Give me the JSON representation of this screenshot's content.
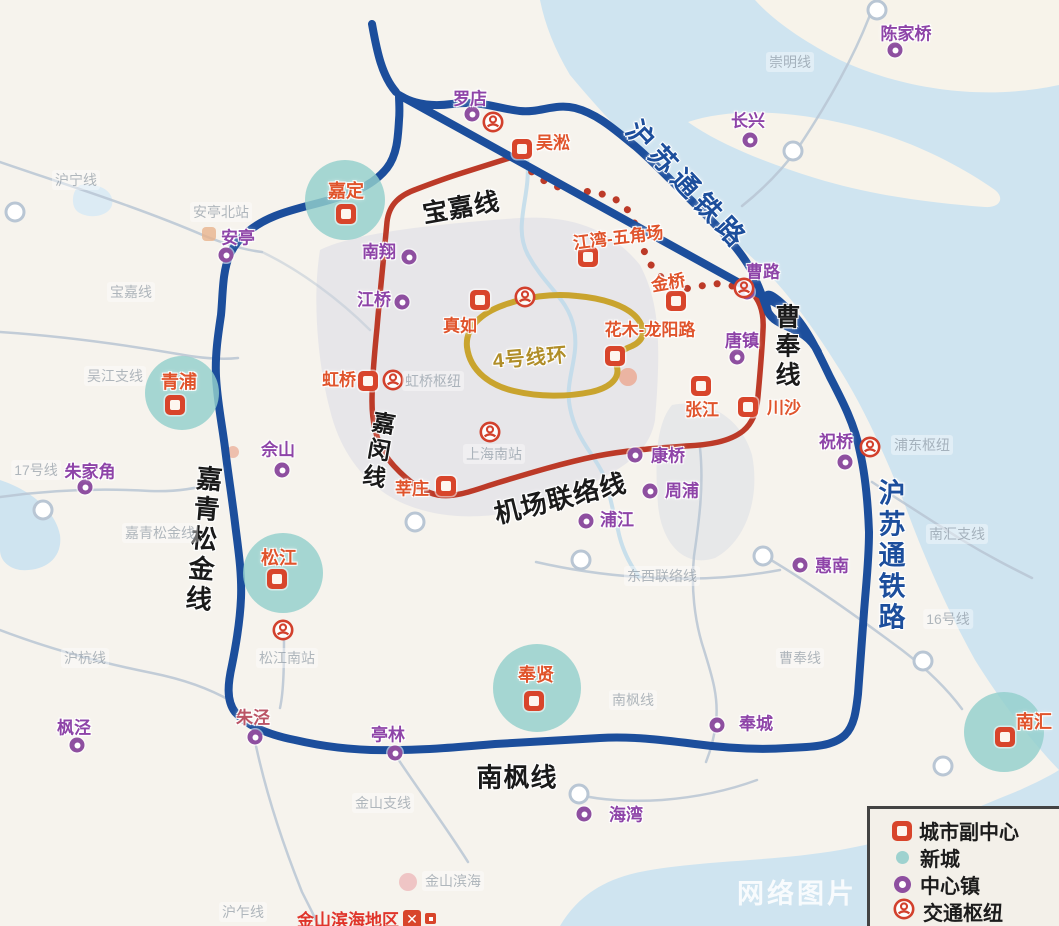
{
  "map": {
    "watermark": "网络图片",
    "colors": {
      "blue_line": "#1c4e9c",
      "red_line": "#bc3a28",
      "gold_line": "#c9a42e",
      "town_purple": "#8e44a8",
      "subcenter_red": "#d8452b",
      "newcity_teal": "#9ed2cf",
      "water": "#cfe4f0"
    },
    "legend": {
      "items": [
        {
          "type": "sub-center",
          "label": "城市副中心"
        },
        {
          "type": "new-city",
          "label": "新城"
        },
        {
          "type": "town",
          "label": "中心镇"
        },
        {
          "type": "hub",
          "label": "交通枢纽"
        }
      ]
    },
    "line_labels": [
      {
        "text": "宝嘉线",
        "x": 461,
        "y": 206,
        "rotate": -10,
        "size": 25,
        "color": "#1a1a1a",
        "vertical": false
      },
      {
        "text": "沪苏通铁路",
        "x": 689,
        "y": 184,
        "rotate": 47,
        "size": 27,
        "color": "#1c4e9c",
        "vertical": false,
        "spacing": 6
      },
      {
        "text": "曹奉线",
        "x": 786,
        "y": 347,
        "rotate": 0,
        "size": 25,
        "color": "#1a1a1a",
        "vertical": true
      },
      {
        "text": "嘉闵线",
        "x": 377,
        "y": 451,
        "rotate": 10,
        "size": 23,
        "color": "#1a1a1a",
        "vertical": true
      },
      {
        "text": "机场联络线",
        "x": 560,
        "y": 497,
        "rotate": -14,
        "size": 26,
        "color": "#1a1a1a",
        "vertical": false
      },
      {
        "text": "嘉青松金线",
        "x": 203,
        "y": 540,
        "rotate": 5,
        "size": 26,
        "color": "#1a1a1a",
        "vertical": true
      },
      {
        "text": "南枫线",
        "x": 517,
        "y": 776,
        "rotate": 0,
        "size": 26,
        "color": "#1a1a1a",
        "vertical": false
      },
      {
        "text": "沪苏通铁路",
        "x": 890,
        "y": 556,
        "rotate": 0,
        "size": 27,
        "color": "#1c4e9c",
        "vertical": true
      },
      {
        "text": "4号线环",
        "x": 530,
        "y": 356,
        "rotate": -5,
        "size": 20,
        "color": "#b08e28",
        "vertical": false
      }
    ],
    "sub_centers": [
      {
        "name": "吴淞",
        "x": 522,
        "y": 149,
        "lx": 553,
        "ly": 141
      },
      {
        "name": "江湾-五角场",
        "x": 588,
        "y": 257,
        "lx": 618,
        "ly": 236,
        "lrot": -7
      },
      {
        "name": "金桥",
        "x": 676,
        "y": 301,
        "lx": 668,
        "ly": 281,
        "lrot": -10
      },
      {
        "name": "真如",
        "x": 480,
        "y": 300,
        "lx": 460,
        "ly": 324
      },
      {
        "name": "花木-龙阳路",
        "x": 615,
        "y": 356,
        "lx": 650,
        "ly": 328
      },
      {
        "name": "虹桥",
        "x": 368,
        "y": 381,
        "lx": 339,
        "ly": 378
      },
      {
        "name": "张江",
        "x": 701,
        "y": 386,
        "lx": 702,
        "ly": 408
      },
      {
        "name": "川沙",
        "x": 748,
        "y": 407,
        "lx": 784,
        "ly": 406
      },
      {
        "name": "莘庄",
        "x": 446,
        "y": 486,
        "lx": 412,
        "ly": 487
      }
    ],
    "new_cities": [
      {
        "name": "嘉定",
        "cx": 345,
        "cy": 200,
        "r": 40,
        "lx": 346,
        "ly": 190,
        "sx": 346,
        "sy": 214
      },
      {
        "name": "青浦",
        "cx": 182,
        "cy": 393,
        "r": 37,
        "lx": 179,
        "ly": 381,
        "sx": 175,
        "sy": 405
      },
      {
        "name": "松江",
        "cx": 283,
        "cy": 573,
        "r": 40,
        "lx": 279,
        "ly": 557,
        "sx": 277,
        "sy": 579
      },
      {
        "name": "奉贤",
        "cx": 537,
        "cy": 688,
        "r": 44,
        "lx": 536,
        "ly": 674,
        "sx": 534,
        "sy": 701
      },
      {
        "name": "南汇",
        "cx": 1004,
        "cy": 732,
        "r": 40,
        "lx": 1034,
        "ly": 721,
        "sx": 1005,
        "sy": 737
      }
    ],
    "towns": [
      {
        "name": "罗店",
        "cx": 472,
        "cy": 114,
        "lx": 470,
        "ly": 97
      },
      {
        "name": "安亭",
        "cx": 226,
        "cy": 255,
        "lx": 238,
        "ly": 236
      },
      {
        "name": "南翔",
        "cx": 409,
        "cy": 257,
        "lx": 379,
        "ly": 250
      },
      {
        "name": "江桥",
        "cx": 402,
        "cy": 302,
        "lx": 374,
        "ly": 298
      },
      {
        "name": "佘山",
        "cx": 282,
        "cy": 470,
        "lx": 278,
        "ly": 448
      },
      {
        "name": "朱家角",
        "cx": 85,
        "cy": 487,
        "lx": 90,
        "ly": 470
      },
      {
        "name": "长兴",
        "cx": 750,
        "cy": 140,
        "lx": 748,
        "ly": 119
      },
      {
        "name": "陈家桥",
        "cx": 895,
        "cy": 50,
        "lx": 906,
        "ly": 32
      },
      {
        "name": "曹路",
        "cx": 747,
        "cy": 292,
        "lx": 763,
        "ly": 270
      },
      {
        "name": "唐镇",
        "cx": 737,
        "cy": 357,
        "lx": 742,
        "ly": 339
      },
      {
        "name": "康桥",
        "cx": 635,
        "cy": 455,
        "lx": 668,
        "ly": 454
      },
      {
        "name": "周浦",
        "cx": 650,
        "cy": 491,
        "lx": 682,
        "ly": 489
      },
      {
        "name": "浦江",
        "cx": 586,
        "cy": 521,
        "lx": 617,
        "ly": 518
      },
      {
        "name": "祝桥",
        "cx": 845,
        "cy": 462,
        "lx": 836,
        "ly": 440
      },
      {
        "name": "惠南",
        "cx": 800,
        "cy": 565,
        "lx": 832,
        "ly": 564
      },
      {
        "name": "奉城",
        "cx": 717,
        "cy": 725,
        "lx": 756,
        "ly": 722
      },
      {
        "name": "海湾",
        "cx": 584,
        "cy": 814,
        "lx": 626,
        "ly": 813
      },
      {
        "name": "亭林",
        "cx": 395,
        "cy": 753,
        "lx": 388,
        "ly": 733
      },
      {
        "name": "枫泾",
        "cx": 77,
        "cy": 745,
        "lx": 74,
        "ly": 726
      },
      {
        "name": "朱泾",
        "cx": 255,
        "cy": 737,
        "lx": 253,
        "ly": 716,
        "color": "#bb5566"
      }
    ],
    "hubs": [
      {
        "x": 493,
        "y": 122
      },
      {
        "x": 525,
        "y": 297
      },
      {
        "x": 393,
        "y": 380
      },
      {
        "x": 490,
        "y": 432
      },
      {
        "x": 283,
        "y": 630
      },
      {
        "x": 870,
        "y": 447
      },
      {
        "x": 744,
        "y": 288
      }
    ],
    "faint_labels": [
      {
        "text": "沪宁线",
        "x": 76,
        "y": 180
      },
      {
        "text": "安亭北站",
        "x": 221,
        "y": 212
      },
      {
        "text": "宝嘉线",
        "x": 131,
        "y": 292
      },
      {
        "text": "吴江支线",
        "x": 115,
        "y": 376
      },
      {
        "text": "17号线",
        "x": 36,
        "y": 470
      },
      {
        "text": "嘉青松金线",
        "x": 160,
        "y": 533
      },
      {
        "text": "虹桥枢纽",
        "x": 433,
        "y": 381
      },
      {
        "text": "上海南站",
        "x": 494,
        "y": 454
      },
      {
        "text": "浦东枢纽",
        "x": 922,
        "y": 445
      },
      {
        "text": "南汇支线",
        "x": 957,
        "y": 534
      },
      {
        "text": "16号线",
        "x": 948,
        "y": 619
      },
      {
        "text": "曹奉线",
        "x": 800,
        "y": 658
      },
      {
        "text": "南枫线",
        "x": 633,
        "y": 700
      },
      {
        "text": "东西联络线",
        "x": 662,
        "y": 576
      },
      {
        "text": "金山支线",
        "x": 383,
        "y": 803
      },
      {
        "text": "沪杭线",
        "x": 85,
        "y": 658
      },
      {
        "text": "松江南站",
        "x": 287,
        "y": 658
      },
      {
        "text": "崇明线",
        "x": 790,
        "y": 62
      },
      {
        "text": "金山滨海",
        "x": 453,
        "y": 881
      },
      {
        "text": "沪乍线",
        "x": 243,
        "y": 912
      }
    ],
    "region_label": {
      "text": "金山滨海地区"
    }
  }
}
